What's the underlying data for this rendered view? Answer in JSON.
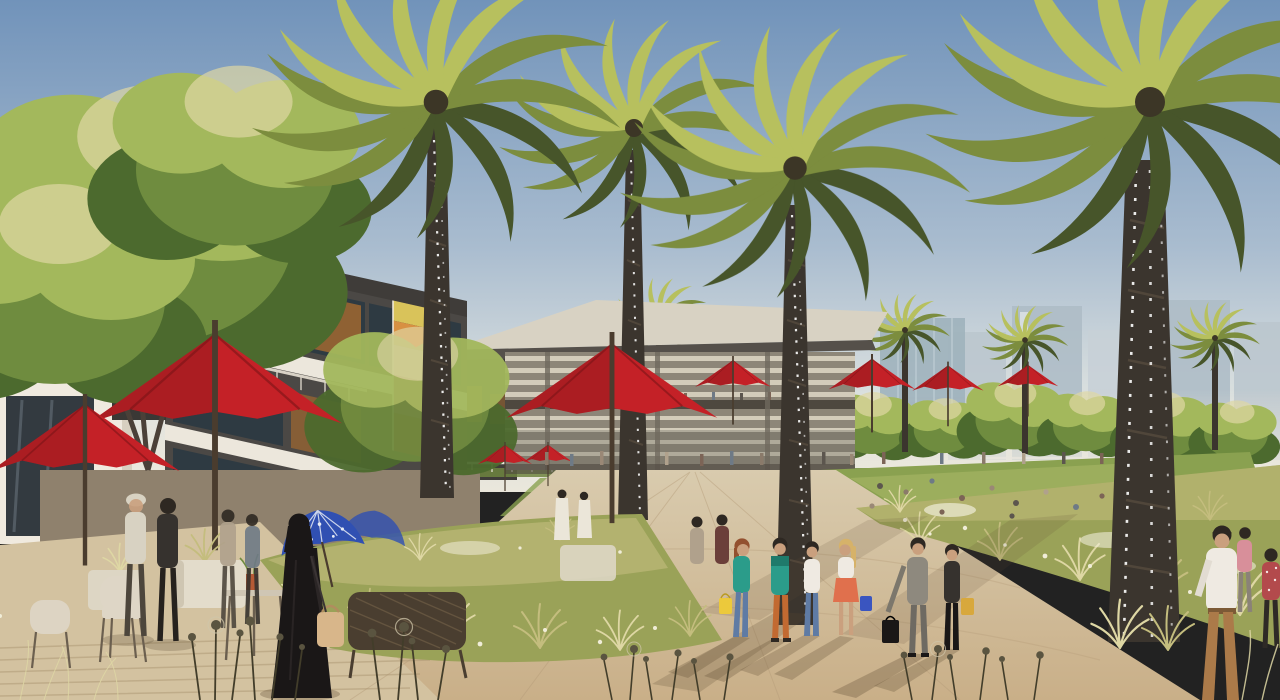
{
  "scene": {
    "type": "architectural-rendering",
    "description": "Sunlit community plaza promenade lined with date palms strung with lights; cafe terrace with red umbrellas at left, modern retail pavilion in the centre, meadow planting and lawns with strolling shoppers, hazy city towers on the horizon",
    "time_of_day": "late-afternoon sun, long shadows cast to the lower-left",
    "elements": [
      "date-palm-trees-with-string-lights",
      "red-cafe-umbrellas",
      "blue-patterned-parasols",
      "two-storey-retail-building-with-colorful-banner",
      "pavilion-with-slanted-roof-and-louvred-facade",
      "hazy-city-towers",
      "meadow-planting-with-white-wildflowers",
      "pedestrians-with-shopping-bags",
      "woman-in-black-abaya-with-tan-handbag",
      "man-in-white-shirt-and-tan-trousers",
      "outdoor-cafe-furniture",
      "timber-deck-boardwalk"
    ]
  },
  "palette": {
    "sky_top": "#7193ba",
    "sky_mid": "#a9bccf",
    "sky_low": "#dde2e0",
    "horizon_haze": "#eae7dc",
    "tower_a": "#bcc7cf",
    "tower_b": "#aebdc7",
    "tower_c": "#c8d1d7",
    "tower_win": "#d9dfe3",
    "frond_light": "#b7c05e",
    "frond_mid": "#7c8d3e",
    "frond_dark": "#47552a",
    "trunk": "#3b352e",
    "trunk_hi": "#5a4f40",
    "light_dot": "#ffffff",
    "tree_light": "#a3b85c",
    "tree_mid": "#6f8c3f",
    "tree_dark": "#4c6a2e",
    "roof_top": "#d8d2c3",
    "roof_fascia": "#55504a",
    "pav_stripe_a": "#d3ccba",
    "pav_stripe_b": "#8d8678",
    "pav_glass": "#6e6a5e",
    "terrace": "#4e483f",
    "column": "#6f695e",
    "glassbox": "#9fb3bd",
    "bld_dark": "#4b4845",
    "bld_white": "#ece7dc",
    "bld_glass": "#2e3a42",
    "bld_wood": "#9a6632",
    "fascia": "#3f3c39",
    "banner_yellow": "#d9c35a",
    "banner_orange": "#d89042",
    "banner_pink": "#e09ec0",
    "banner_magenta": "#b83f77",
    "banner_red": "#b23236",
    "store_white": "#f0eadf",
    "store_glass": "#333a40",
    "awning": "#3a3835",
    "shade_ground": "#8f816d",
    "hedge": "#6e8440",
    "lawn": "#8aa150",
    "lawn_light": "#a9b866",
    "meadow": "#9aa258",
    "meadow_tan": "#c4bd7e",
    "grass_hi": "#ded7a4",
    "flower_white": "#f0edd8",
    "walk": "#d9cbae",
    "walk_warm": "#c9af88",
    "walk_line": "#b59c79",
    "deck": "#d3c2a0",
    "deck_line": "#ab9671",
    "shadow": "#5d4a33",
    "umb_red": "#c42127",
    "umb_red_dark": "#8e181d",
    "umb_pole": "#4a3c2e",
    "parasol_blue": "#3050b2",
    "parasol_white": "#e8ecf5",
    "fence_white": "#e9e6dd",
    "pole_white": "#eceadf",
    "skin": "#caa07e",
    "hair_dark": "#2e2822",
    "c_teal": "#2b9c8a",
    "c_orange": "#c26a31",
    "c_jeans": "#5f7ba4",
    "c_white": "#efeae2",
    "c_coral": "#e0704d",
    "c_blonde": "#d6b269",
    "c_auburn": "#93502f",
    "c_yellowbag": "#ecc93b",
    "c_bluebag": "#3a55c0",
    "c_suit": "#8e897e",
    "c_suit_dark": "#6e6a62",
    "c_dark": "#36322e",
    "c_mustard": "#d8a83c",
    "c_black": "#1a1717",
    "c_bag_tan": "#d8b68a",
    "c_tan_pants": "#ab7a49",
    "c_pink": "#d88f9a",
    "c_redfloral": "#b34a4c",
    "c_hat": "#d8d2c2",
    "c_thobe": "#ebe6d9",
    "wicker": "#ded6c6",
    "wicker_dark": "#6b5f4f",
    "bench_dark": "#4a3e30",
    "bench_weave": "#6a5a44",
    "plant_sil": "#423d2a",
    "plant_head": "#5a5440",
    "crowd_1": "#8a7a6a",
    "crowd_2": "#6e7a86",
    "crowd_3": "#9a8876",
    "crowd_4": "#5c564e",
    "crowd_5": "#b0a18c",
    "crowd_6": "#7c6456"
  }
}
